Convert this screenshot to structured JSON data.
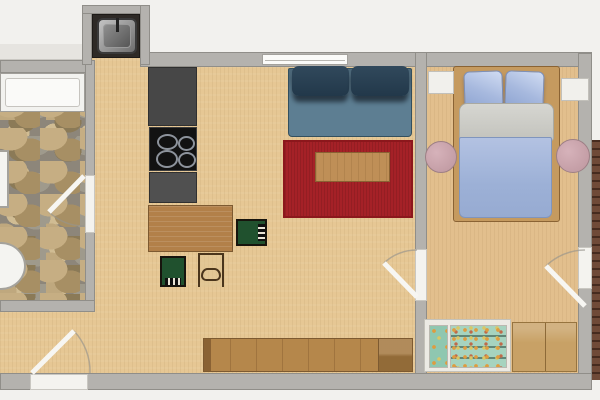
{
  "document": {
    "kind": "apartment floor plan, top-down 2D render",
    "visible_text": []
  },
  "palette": {
    "outside": "#f2f1ee",
    "wall_gray": "#b4b2ae",
    "floor_wood": "#e6c794",
    "bedroom_floor": "#e2bf8d",
    "bathroom_grout": "#8d867a",
    "sofa_blue": "#5d7e92",
    "cushion_navy": "#22384a",
    "rug_red": "#a52127",
    "wood_tan": "#b28049",
    "chair_green": "#20512e",
    "counter_dark": "#474747",
    "cooktop_black": "#121212",
    "duvet_blue": "#9cb0d6",
    "pillow_blue": "#a7b9de",
    "pouf_pink": "#c9a3ab",
    "bookshelf_teal": "#a6d3bf",
    "porcelain_white": "#f4f4f1",
    "brick_outside": "#6f4a38"
  },
  "rooms": [
    {
      "id": "bathroom",
      "floor": "flagstone",
      "fixtures": [
        "bathtub",
        "washbasin",
        "toilet"
      ]
    },
    {
      "id": "kitchen-living-room",
      "floor": "light wood",
      "fixtures": [
        "sink-niche",
        "counter-with-cooktop",
        "dining-table",
        "green-chair-right",
        "green-chair-bottom",
        "frame-chair",
        "sofa",
        "red-rug",
        "coffee-table",
        "sideboard"
      ]
    },
    {
      "id": "bedroom",
      "floor": "light wood",
      "fixtures": [
        "double-bed",
        "pillow-left",
        "pillow-right",
        "nightstand-left",
        "nightstand-right",
        "pouf-left",
        "pouf-right",
        "bookshelf",
        "dresser"
      ]
    }
  ],
  "openings": {
    "windows": [
      {
        "id": "living-room-top-window"
      }
    ],
    "doors": [
      {
        "id": "bathroom-door",
        "swing": "into bathroom"
      },
      {
        "id": "entrance-door",
        "swing": "into living room, bottom wall"
      },
      {
        "id": "bedroom-door",
        "swing": "into living room"
      },
      {
        "id": "bedroom-right-door",
        "swing": "into bedroom, right wall"
      }
    ]
  },
  "cooktop": {
    "burners": 4
  },
  "sofa": {
    "seats": 2
  },
  "bed": {
    "pillows": 2
  }
}
